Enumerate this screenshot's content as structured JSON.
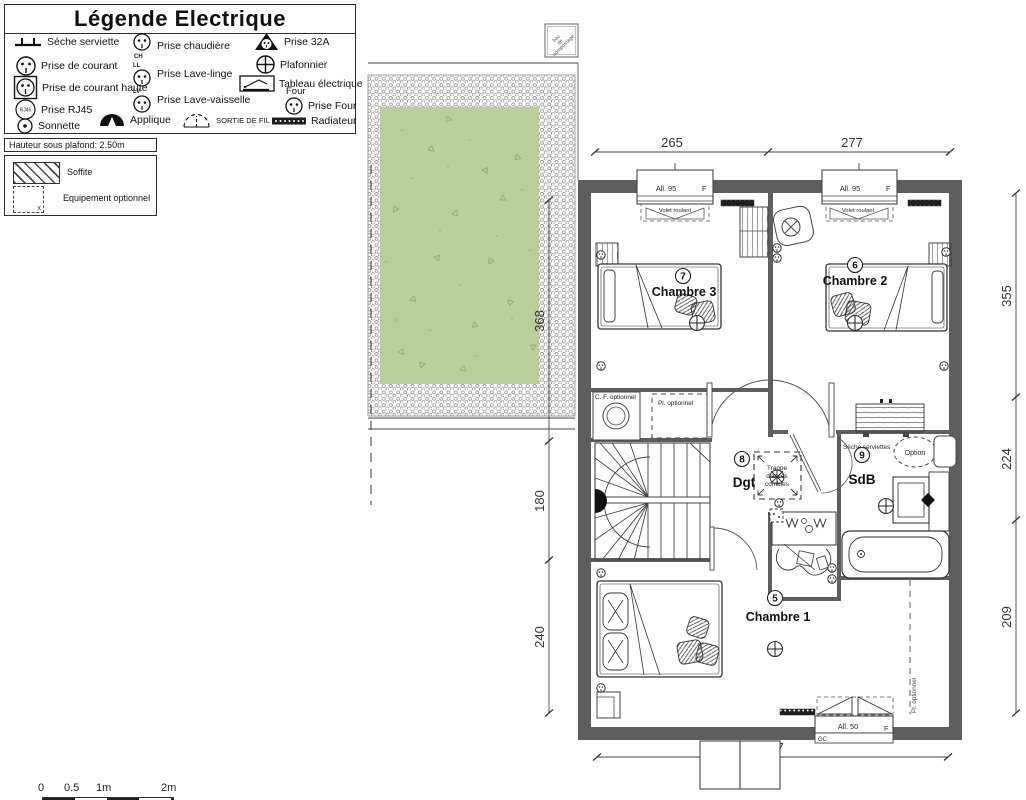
{
  "legend": {
    "title": "Légende Electrique",
    "rj45_text": "RJ45",
    "items": [
      {
        "label": "Séche serviette"
      },
      {
        "label": "Prise de courant"
      },
      {
        "label": "Prise de courant haute"
      },
      {
        "label": "Prise RJ45"
      },
      {
        "label": "Sonnette"
      },
      {
        "label": "Prise chaudière",
        "tag": "CH"
      },
      {
        "label": "Prise Lave-linge",
        "tag": "LL"
      },
      {
        "label": "Prise Lave-vaisselle",
        "tag": "LV"
      },
      {
        "label": "Applique"
      },
      {
        "label": "Prise 32A"
      },
      {
        "label": "Plafonnier"
      },
      {
        "label": "Tableau électrique"
      },
      {
        "label": "Prise Four",
        "tag": "Four"
      },
      {
        "label": "SORTIE DE FIL"
      },
      {
        "label": "Radiateur"
      }
    ]
  },
  "info_box": {
    "ceiling_height": "Hauteur sous plafond: 2.50m",
    "soffite_label": "Soffite",
    "optional_label": "Equipement optionnel",
    "optional_marker": "x"
  },
  "site": {
    "compost_lines": [
      "bac",
      "de",
      "compostage"
    ]
  },
  "plan": {
    "rooms": [
      {
        "number": "7",
        "name": "Chambre 3"
      },
      {
        "number": "6",
        "name": "Chambre 2"
      },
      {
        "number": "8",
        "name": "Dgt"
      },
      {
        "number": "9",
        "name": "SdB"
      },
      {
        "number": "5",
        "name": "Chambre 1"
      }
    ],
    "annotations": {
      "cf_optional": "C. F. optionnel",
      "placard_optional": "Pl. optionnel",
      "placard_optional_vertical": "Pl. optionnel",
      "trappe_line1": "Trappe",
      "trappe_line2": "d'accès",
      "trappe_line3": "combles",
      "seche_serviettes": "Sèche serviettes",
      "option": "Option"
    },
    "windows": [
      {
        "sill": "All. 95",
        "type": "F",
        "shutter": "Volet roulant"
      },
      {
        "sill": "All. 95",
        "type": "F",
        "shutter": "Volet roulant"
      },
      {
        "sill": "All. 50",
        "type": "F",
        "note": "GC"
      }
    ],
    "dimensions": {
      "top": [
        "265",
        "277"
      ],
      "left": [
        "368",
        "180",
        "240"
      ],
      "right": [
        "355",
        "224",
        "209"
      ],
      "bottom": [
        "547"
      ]
    }
  },
  "scale_bar": {
    "labels": [
      "0",
      "0.5",
      "1m",
      "2m"
    ]
  },
  "colors": {
    "wall": "#5e5e5e",
    "grass": "#b8cf9c",
    "line": "#3d3d3d",
    "dim_text": "#333333"
  }
}
